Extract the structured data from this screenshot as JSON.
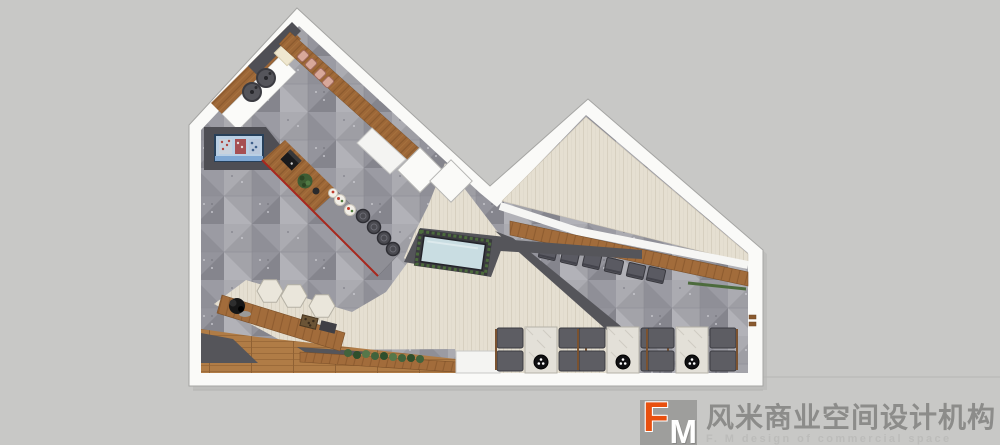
{
  "app": {
    "kind": "restaurant floor plan rendering (top view)"
  },
  "logo": {
    "mark_letter_f": "F",
    "mark_letter_m": "M",
    "company_zh": "风米商业空间设计机构",
    "company_en": "F. M design of commercial space"
  },
  "palette": {
    "accent-orange": "#e8500f",
    "logo-gray": "#9e9e9c",
    "text-zh": "#8c8c8a",
    "text-en": "#bcbcba",
    "canvas-bg": "#c8c8c6",
    "wall-white": "#fafaf8",
    "tile-gray": "#97979d",
    "plank-beige": "#e5dfd1",
    "wood-brown": "#9d6737",
    "dark-wall": "#55555a",
    "water-blue": "#c9dde2",
    "plant-green": "#4c6b3c",
    "bar-red-edge": "#a8281e"
  },
  "plan": {
    "cooktops": 2,
    "display_fridge": 1,
    "bar_stools": 4,
    "window_seat_pads": 4,
    "hex_tables": 3,
    "water_feature": 1,
    "private_room_chairs": 6,
    "four_seat_dining_sets": 3,
    "entry_mats": 2
  }
}
